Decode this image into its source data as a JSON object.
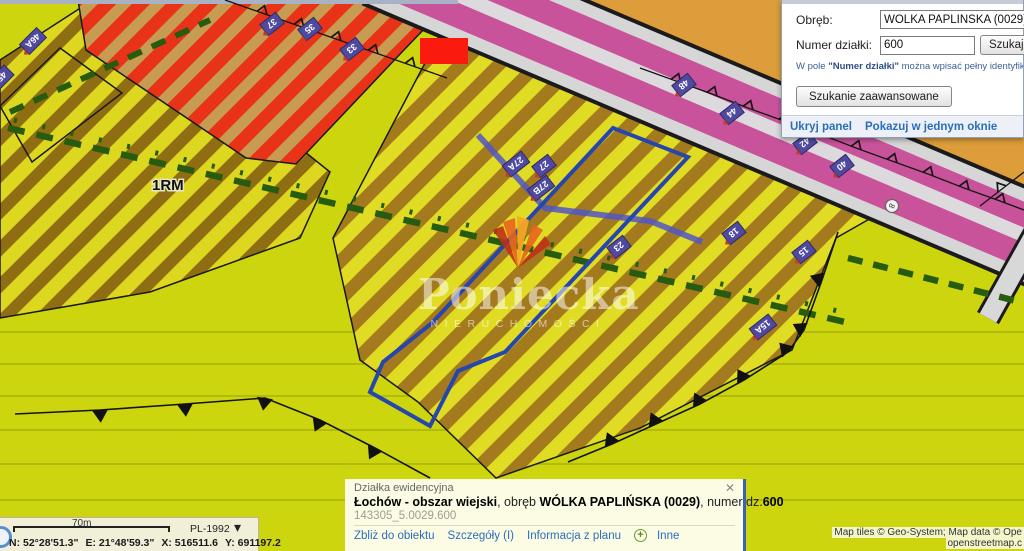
{
  "panel": {
    "obreb_label": "Obręb:",
    "obreb_value": "WÓLKA PAPLIŃSKA (0029)",
    "numer_label": "Numer działki:",
    "numer_value": "600",
    "szukaj_button": "Szukaj",
    "help_prefix": "W pole ",
    "help_bold": "\"Numer działki\"",
    "help_suffix": " można wpisać pełny identyfikator szukane",
    "advanced_button": "Szukanie zaawansowane",
    "hide_panel_link": "Ukryj panel",
    "single_window_link": "Pokazuj w jednym oknie"
  },
  "popup": {
    "title": "Działka ewidencyjna",
    "name_bold": "Łochów - obszar wiejski",
    "sep1": ", obręb ",
    "obreb_bold": "WÓLKA PAPLIŃSKA (0029)",
    "sep2": ", numer dz.",
    "number_bold": "600",
    "identifier": "143305_5.0029.600",
    "link_zoom": "Zbliż do obiektu",
    "link_details": "Szczegóły (I)",
    "link_plan": "Informacja z planu",
    "link_other": "Inne"
  },
  "statusbar": {
    "scale_label": "70m",
    "crs": "PL-1992",
    "coord_n": "N: 52°28'51.3\"",
    "coord_e": "E: 21°48'59.3\"",
    "coord_x": "X: 516511.6",
    "coord_y": "Y: 691197.2"
  },
  "attribution": {
    "line1": "Map tiles © Geo-System; Map data © Ope",
    "line2": "openstreetmap.c"
  },
  "map": {
    "zone_label": "1RM",
    "road_point_label": "8",
    "watermark_name": "Poniecka",
    "watermark_subtitle": "NIERUCHOMOŚCI",
    "parcel_labels": [
      {
        "text": "46A"
      },
      {
        "text": "45"
      },
      {
        "text": "37"
      },
      {
        "text": "35"
      },
      {
        "text": "33"
      },
      {
        "text": "48"
      },
      {
        "text": "44"
      },
      {
        "text": "42"
      },
      {
        "text": "40"
      },
      {
        "text": "27A"
      },
      {
        "text": "27"
      },
      {
        "text": "27B"
      },
      {
        "text": "23"
      },
      {
        "text": "18"
      },
      {
        "text": "15"
      },
      {
        "text": "15A"
      }
    ]
  },
  "icons": {
    "close": "✕",
    "chevron_down": "▾",
    "plus": "+"
  },
  "colors": {
    "accent_blue": "#2a6ebb",
    "parcel_outline": "#2746ad",
    "selection_red": "#fa1a0e"
  }
}
